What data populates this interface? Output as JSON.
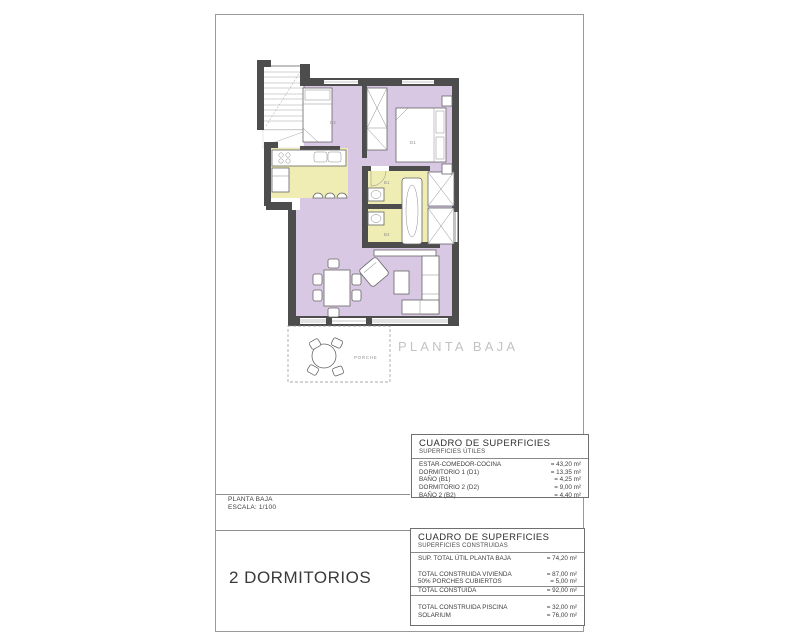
{
  "colors": {
    "wall": "#4d4d4d",
    "floor_purple": "#d9c8e3",
    "floor_yellow": "#f0edb4",
    "caption_gray": "#c3c3c3"
  },
  "plan": {
    "caption": "PLANTA BAJA",
    "labels": {
      "d1": "D1",
      "d2": "D2",
      "b1": "B1",
      "b2": "B2",
      "porch": "PORCHE"
    }
  },
  "tables": {
    "utiles": {
      "title": "CUADRO DE SUPERFICIES",
      "subtitle": "SUPERFICIES ÚTILES",
      "rows": [
        {
          "label": "ESTAR-COMEDOR-COCINA",
          "value": "= 43,20 m²"
        },
        {
          "label": "DORMITORIO 1 (D1)",
          "value": "= 13,35 m²"
        },
        {
          "label": "BAÑO (B1)",
          "value": "= 4,25 m²"
        },
        {
          "label": "DORMITORIO 2 (D2)",
          "value": "= 9,00 m²"
        },
        {
          "label": "BAÑO 2 (B2)",
          "value": "= 4,40 m²"
        }
      ]
    },
    "construidas": {
      "title": "CUADRO DE SUPERFICIES",
      "subtitle": "SUPERFICIES CONSTRUIDAS",
      "rows": [
        {
          "label": "SUP. TOTAL ÚTIL PLANTA BAJA",
          "value": "= 74,20 m²"
        },
        {
          "label": "TOTAL CONSTRUIDA VIVIENDA",
          "value": "= 87,00 m²"
        },
        {
          "label": "50% PORCHES CUBIERTOS",
          "value": "= 5,00 m²"
        },
        {
          "label": "TOTAL CONSTUIDA",
          "value": "= 92,00 m²"
        },
        {
          "label": "TOTAL CONSTRUIDA PISCINA",
          "value": "= 32,00 m²"
        },
        {
          "label": "SOLARIUM",
          "value": "= 76,00 m²"
        }
      ]
    }
  },
  "title_block": {
    "plan_name": "PLANTA BAJA",
    "scale": "ESCALA: 1/100",
    "type_label": "2 DORMITORIOS"
  }
}
